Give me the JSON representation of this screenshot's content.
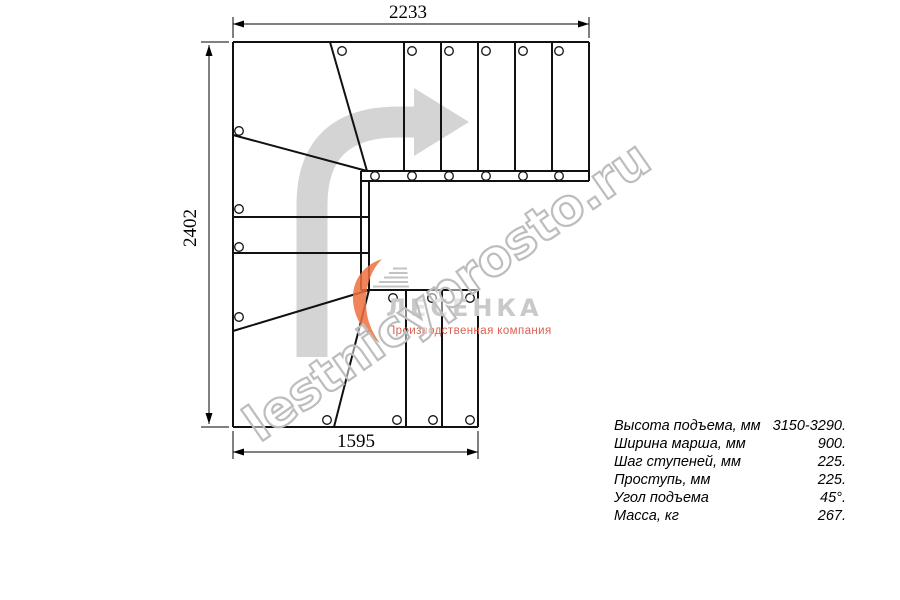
{
  "drawing": {
    "type": "stair-plan-top-view",
    "dimensions_mm": {
      "top": "2233",
      "left": "2402",
      "bottom": "1595"
    }
  },
  "specs": {
    "rows": [
      {
        "label": "Высота подъема, мм",
        "value": "3150-3290."
      },
      {
        "label": "Ширина марша, мм",
        "value": "900."
      },
      {
        "label": "Шаг ступеней, мм",
        "value": "225."
      },
      {
        "label": "Проступь, мм",
        "value": "225."
      },
      {
        "label": "Угол подъема",
        "value": "45°."
      },
      {
        "label": "Масса, кг",
        "value": "267."
      }
    ]
  },
  "logo": {
    "name": "ЛЕСЕНКА",
    "tagline": "Производственная компания"
  },
  "watermark": {
    "text": "lestnicyprosto.ru"
  },
  "icons": [
    "direction-arrow-icon",
    "logo-flame-icon"
  ],
  "colors": {
    "plan_line": "#111111",
    "dimension_line": "#000000",
    "direction_arrow": "#d4d4d4",
    "watermark_outline": "#bdbdbd",
    "logo_flame_orange": "#ee7040",
    "logo_stairs_gray": "#b9b9b9",
    "logo_name_gray": "#c9c9c9",
    "logo_tagline_red": "#dc6050"
  }
}
